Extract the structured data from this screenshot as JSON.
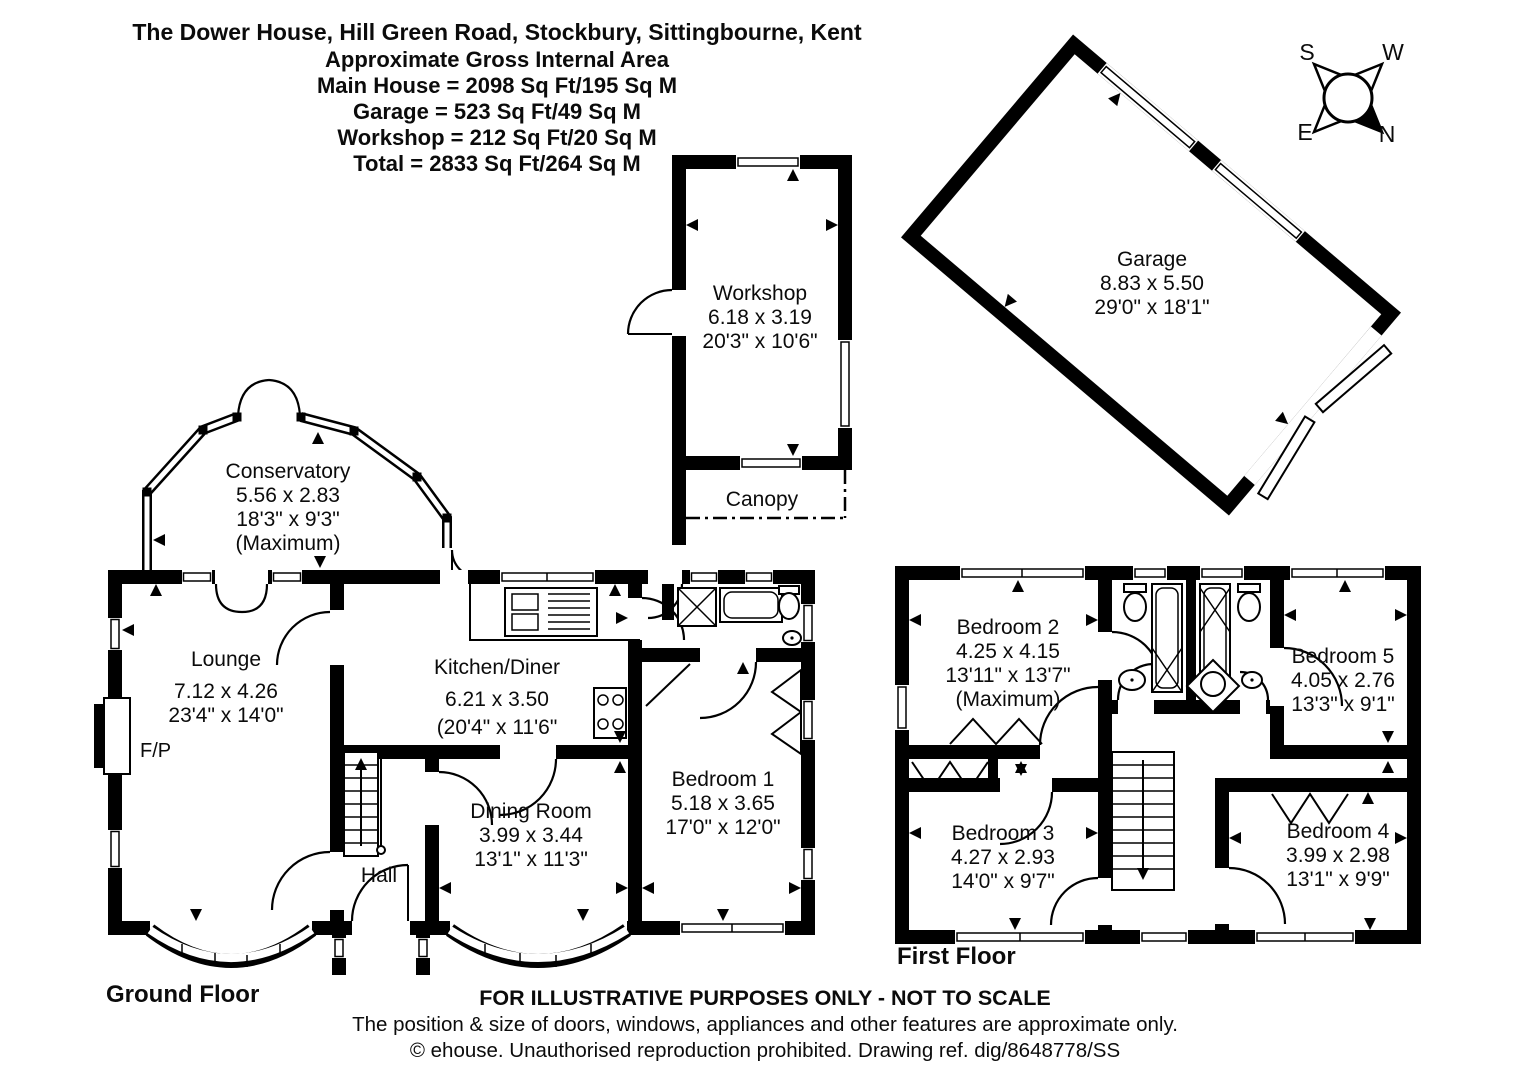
{
  "header": {
    "title": "The Dower House, Hill Green Road, Stockbury, Sittingbourne, Kent",
    "subtitle": "Approximate Gross Internal Area",
    "main_house": "Main House = 2098 Sq Ft/195 Sq M",
    "garage": "Garage = 523 Sq Ft/49 Sq M",
    "workshop": "Workshop = 212 Sq Ft/20 Sq M",
    "total": "Total = 2833 Sq Ft/264 Sq M"
  },
  "compass": {
    "n": "N",
    "s": "S",
    "e": "E",
    "w": "W"
  },
  "outbuildings": {
    "workshop": {
      "name": "Workshop",
      "metric": "6.18 x 3.19",
      "imperial": "20'3\" x 10'6\""
    },
    "canopy": {
      "name": "Canopy"
    },
    "garage": {
      "name": "Garage",
      "metric": "8.83 x 5.50",
      "imperial": "29'0\" x 18'1\""
    }
  },
  "ground_floor": {
    "label": "Ground Floor",
    "rooms": {
      "conservatory": {
        "name": "Conservatory",
        "metric": "5.56 x 2.83",
        "imperial": "18'3\" x 9'3\"",
        "note": "(Maximum)"
      },
      "lounge": {
        "name": "Lounge",
        "metric": "7.12 x 4.26",
        "imperial": "23'4\" x 14'0\""
      },
      "kitchen_diner": {
        "name": "Kitchen/Diner",
        "metric": "6.21 x 3.50",
        "imperial": "(20'4\" x 11'6\""
      },
      "dining_room": {
        "name": "Dining Room",
        "metric": "3.99 x 3.44",
        "imperial": "13'1\" x 11'3\""
      },
      "bedroom1": {
        "name": "Bedroom 1",
        "metric": "5.18 x 3.65",
        "imperial": "17'0\" x 12'0\""
      },
      "hall": {
        "name": "Hall"
      },
      "fireplace": {
        "name": "F/P"
      }
    }
  },
  "first_floor": {
    "label": "First Floor",
    "rooms": {
      "bedroom2": {
        "name": "Bedroom 2",
        "metric": "4.25 x 4.15",
        "imperial": "13'11\" x 13'7\"",
        "note": "(Maximum)"
      },
      "bedroom3": {
        "name": "Bedroom 3",
        "metric": "4.27 x 2.93",
        "imperial": "14'0\" x 9'7\""
      },
      "bedroom4": {
        "name": "Bedroom 4",
        "metric": "3.99 x 2.98",
        "imperial": "13'1\" x 9'9\""
      },
      "bedroom5": {
        "name": "Bedroom 5",
        "metric": "4.05 x 2.76",
        "imperial": "13'3\" x 9'1\""
      }
    }
  },
  "footer": {
    "line1": "FOR ILLUSTRATIVE PURPOSES ONLY - NOT TO SCALE",
    "line2": "The position & size of doors, windows, appliances and other features are approximate only.",
    "line3": "© ehouse. Unauthorised reproduction prohibited. Drawing ref. dig/8648778/SS"
  }
}
